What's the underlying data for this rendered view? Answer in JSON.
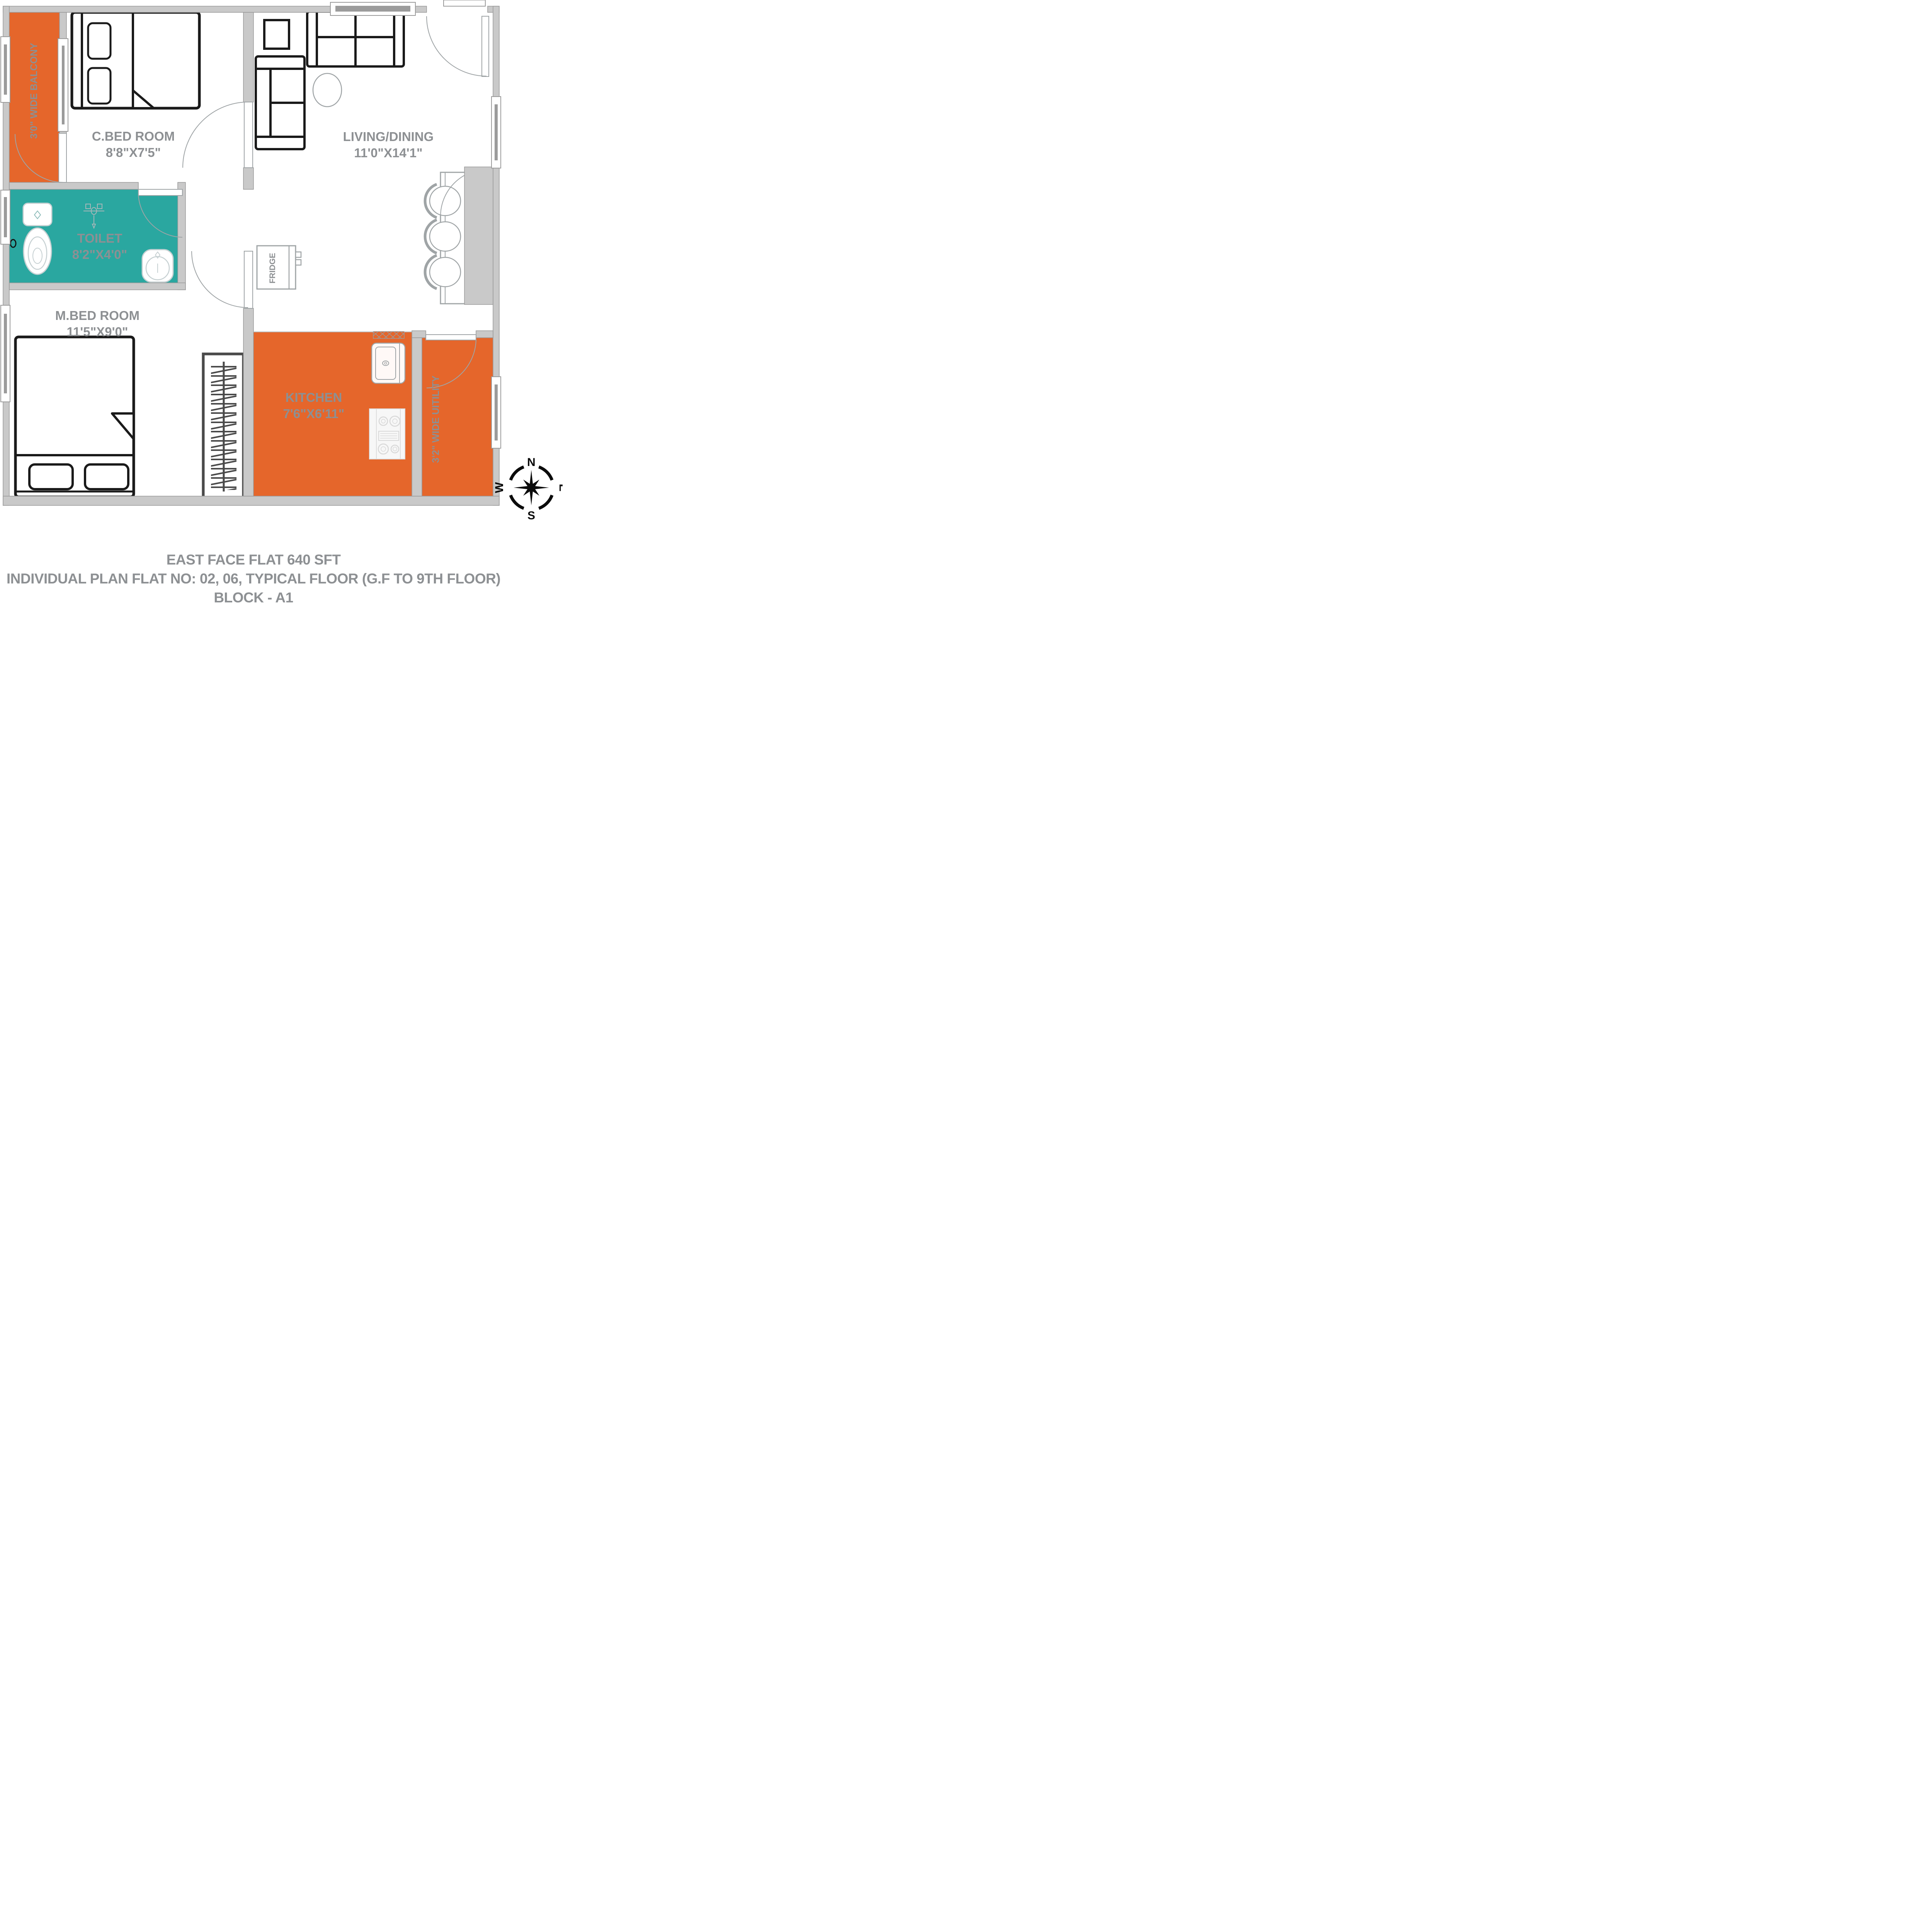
{
  "plan": {
    "rooms": {
      "cbed": {
        "name": "C.BED ROOM",
        "dims": "8'8\"X7'5\""
      },
      "living": {
        "name": "LIVING/DINING",
        "dims": "11'0\"X14'1\""
      },
      "toilet": {
        "name": "TOILET",
        "dims": "8'2\"X4'0\""
      },
      "mbed": {
        "name": "M.BED ROOM",
        "dims": "11'5\"X9'0\""
      },
      "kitchen": {
        "name": "KITCHEN",
        "dims": "7'6\"X6'11\""
      },
      "balcony": {
        "label": "3'0\" WIDE BALCONY"
      },
      "utility": {
        "label": "3'2\" WIDE UITILITY"
      }
    },
    "fixtures": {
      "fridge": "FRIDGE"
    },
    "compass": {
      "n": "N",
      "e": "E",
      "s": "S",
      "w": "W"
    },
    "colors": {
      "orange": "#E5662B",
      "teal": "#2AA7A0",
      "wall": "#C9C9C9",
      "wall_line": "#999999",
      "label": "#8D9093",
      "furniture": "#1A1A1A"
    }
  },
  "caption": {
    "line1": "EAST FACE FLAT 640 SFT",
    "line2": "INDIVIDUAL PLAN FLAT NO: 02, 06, TYPICAL FLOOR (G.F TO 9TH FLOOR)",
    "line3": "BLOCK - A1"
  }
}
